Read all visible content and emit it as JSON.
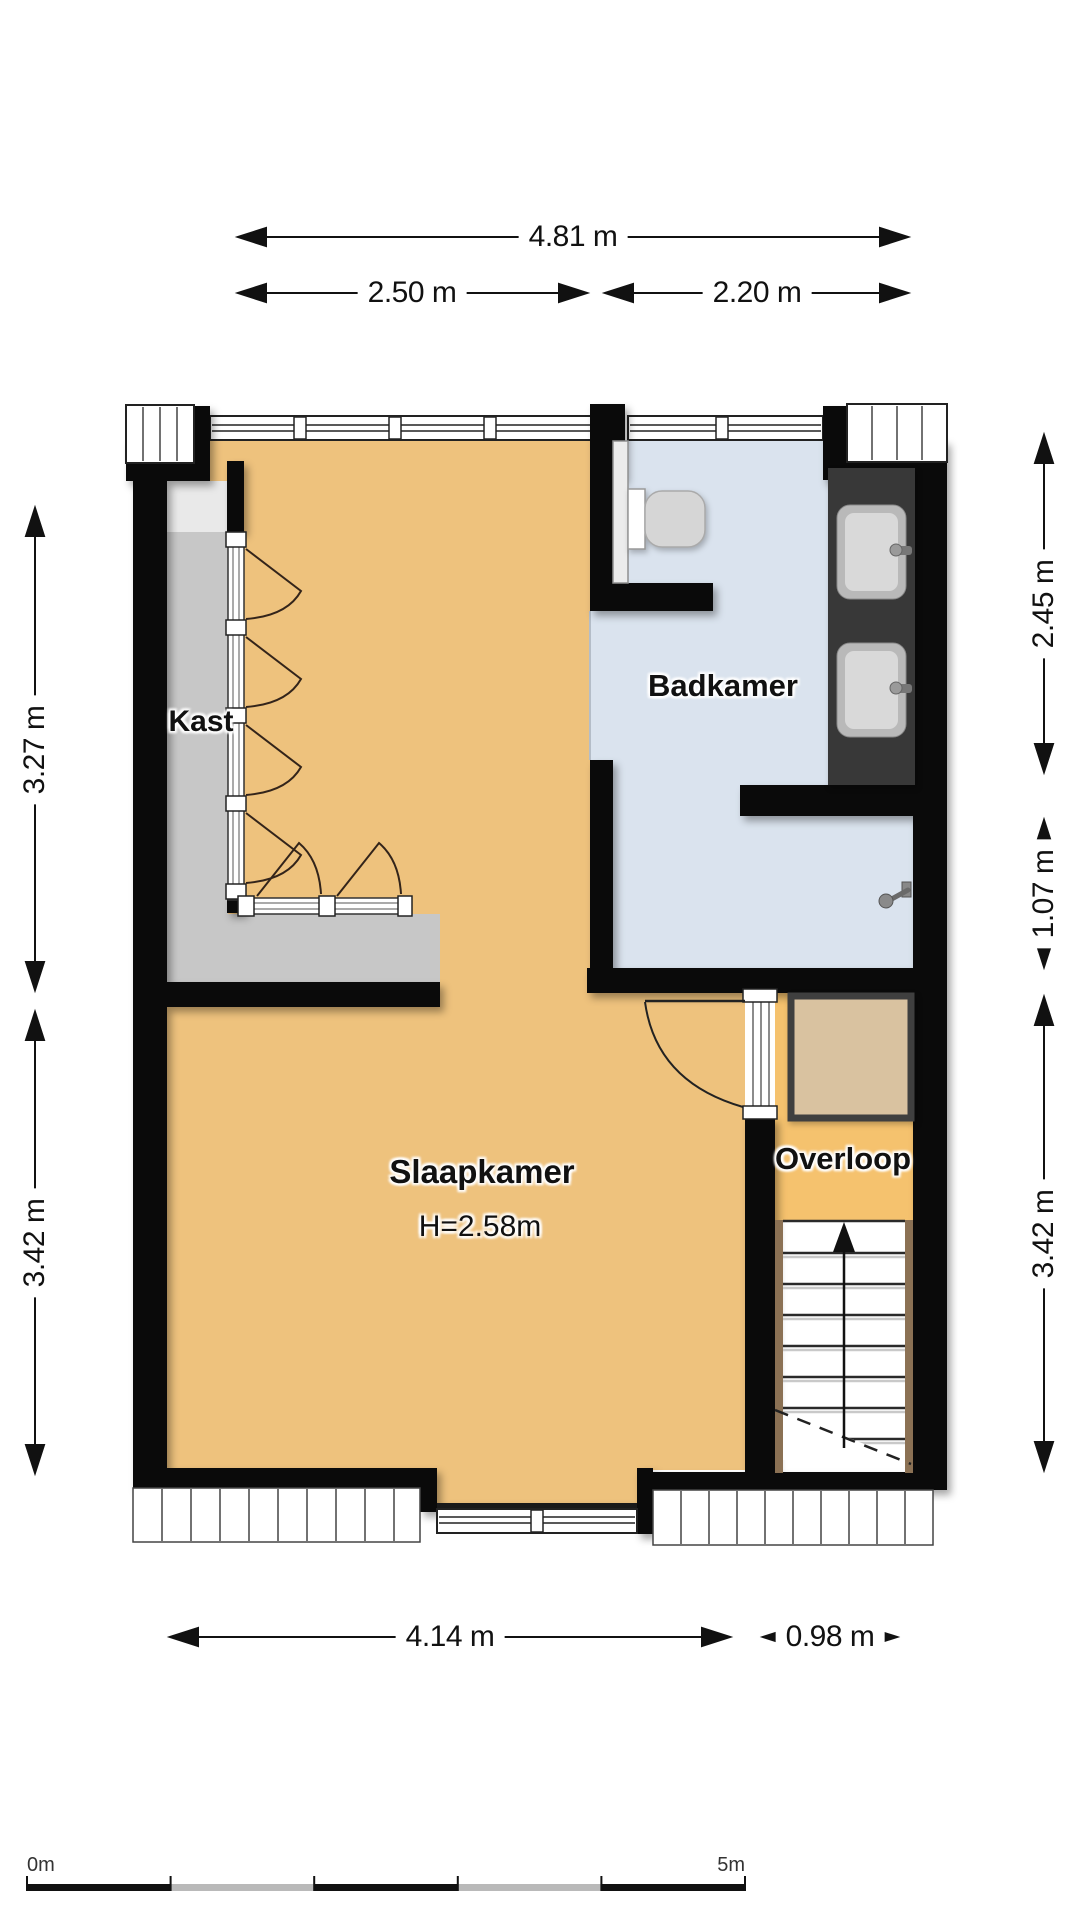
{
  "floorplan": {
    "rooms": {
      "kast": "Kast",
      "badkamer": "Badkamer",
      "slaapkamer": "Slaapkamer",
      "slaapkamer_height": "H=2.58m",
      "overloop": "Overloop"
    },
    "dimensions": {
      "top_total": "4.81 m",
      "top_left": "2.50 m",
      "top_right": "2.20 m",
      "left_upper": "3.27 m",
      "left_lower": "3.42 m",
      "right_upper": "2.45 m",
      "right_middle": "1.07 m",
      "right_lower": "3.42 m",
      "bottom_left": "4.14 m",
      "bottom_right": "0.98 m"
    },
    "scale_bar": {
      "start": "0m",
      "end": "5m"
    },
    "colors": {
      "wall": "#0a0a0a",
      "bedroom_floor": "#eec27d",
      "bathroom_floor": "#dae3ee",
      "closet_floor": "#c7c7c7",
      "closet_floor_light": "#e9e9e9",
      "landing_floor": "#f5c26e",
      "counter": "#383838",
      "void_square": "#d9c2a0",
      "stairs_stringer": "#8b7154"
    }
  }
}
